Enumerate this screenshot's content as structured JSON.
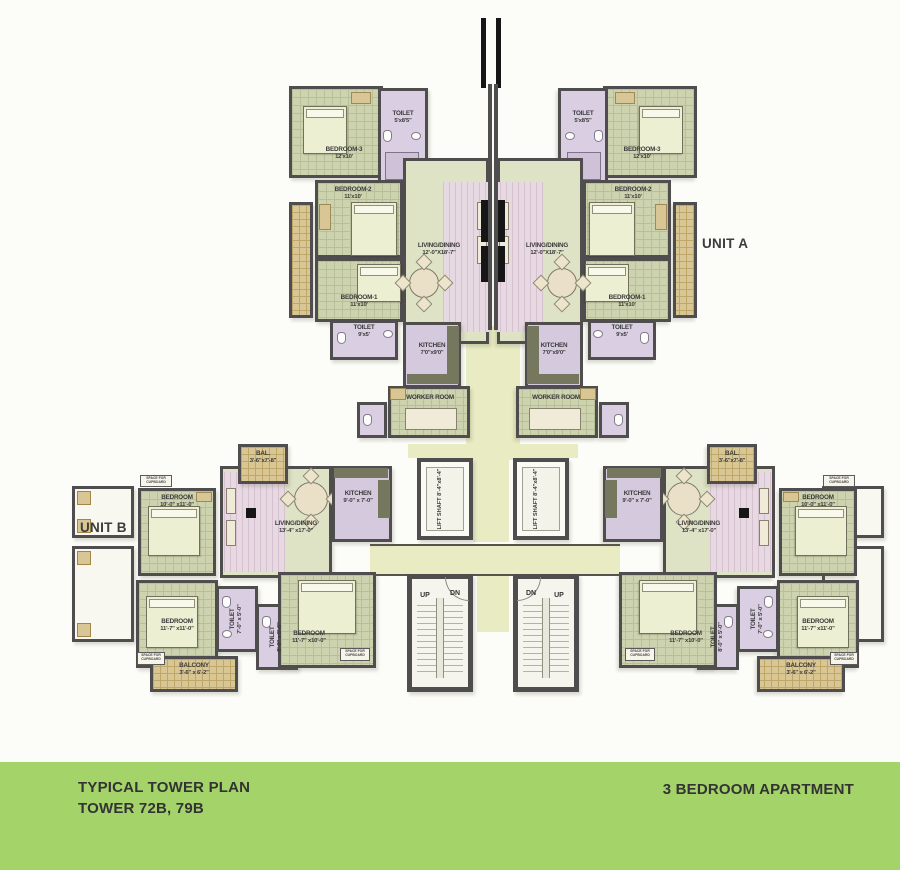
{
  "footer": {
    "line1": "TYPICAL TOWER PLAN",
    "line2": "TOWER 72B, 79B",
    "right": "3 BEDROOM APARTMENT"
  },
  "unit_labels": {
    "unit_a": "UNIT A",
    "unit_b": "UNIT B"
  },
  "stairs": {
    "up": "UP",
    "down": "DN"
  },
  "core": {
    "lift": {
      "name": "LIFT SHAFT",
      "dim": "8'-4\"x8'-4\""
    }
  },
  "unit_a_rooms": {
    "bedroom3": {
      "name": "BEDROOM-3",
      "dim": "12'x10'"
    },
    "toilet_top": {
      "name": "TOILET",
      "dim": "5'x8'5\""
    },
    "bedroom2": {
      "name": "BEDROOM-2",
      "dim": "11'x10'"
    },
    "bedroom1": {
      "name": "BEDROOM-1",
      "dim": "11'x10'"
    },
    "living": {
      "name": "LIVING/DINING",
      "dim": "12'-0\"X18'-7\""
    },
    "toilet": {
      "name": "TOILET",
      "dim": "9'x5'"
    },
    "kitchen": {
      "name": "KITCHEN",
      "dim": "7'0\"x9'0\""
    },
    "worker": {
      "name": "WORKER ROOM"
    }
  },
  "unit_b_rooms": {
    "balcony_top": {
      "name": "BAL.",
      "dim": "3'-6\"x7'-8\""
    },
    "bedroom_top": {
      "name": "BEDROOM",
      "dim": "10'-0\" x11'-0\""
    },
    "living": {
      "name": "LIVING/DINING",
      "dim": "13'-4\" x17'-0\""
    },
    "kitchen": {
      "name": "KITCHEN",
      "dim": "9'-0\" x 7'-0\""
    },
    "bedroom_corner": {
      "name": "BEDROOM",
      "dim": "11'-7\" x11'-0\""
    },
    "bedroom_mid": {
      "name": "BEDROOM",
      "dim": "11'-7\" x10'-0\""
    },
    "toilet_1": {
      "name": "TOILET",
      "dim": "7'-0\" x 5'-0\""
    },
    "toilet_2": {
      "name": "TOILET",
      "dim": "8'-0\" x 5'-0\""
    },
    "balcony_bottom": {
      "name": "BALCONY",
      "dim": "3'-6\" x 6'-2\""
    },
    "cupboard_note": "SPACE FOR CUPBOARD"
  },
  "colors": {
    "footer_green": "#a3d369",
    "wall": "#4f4d4e",
    "corridor": "#e9ecc2"
  }
}
